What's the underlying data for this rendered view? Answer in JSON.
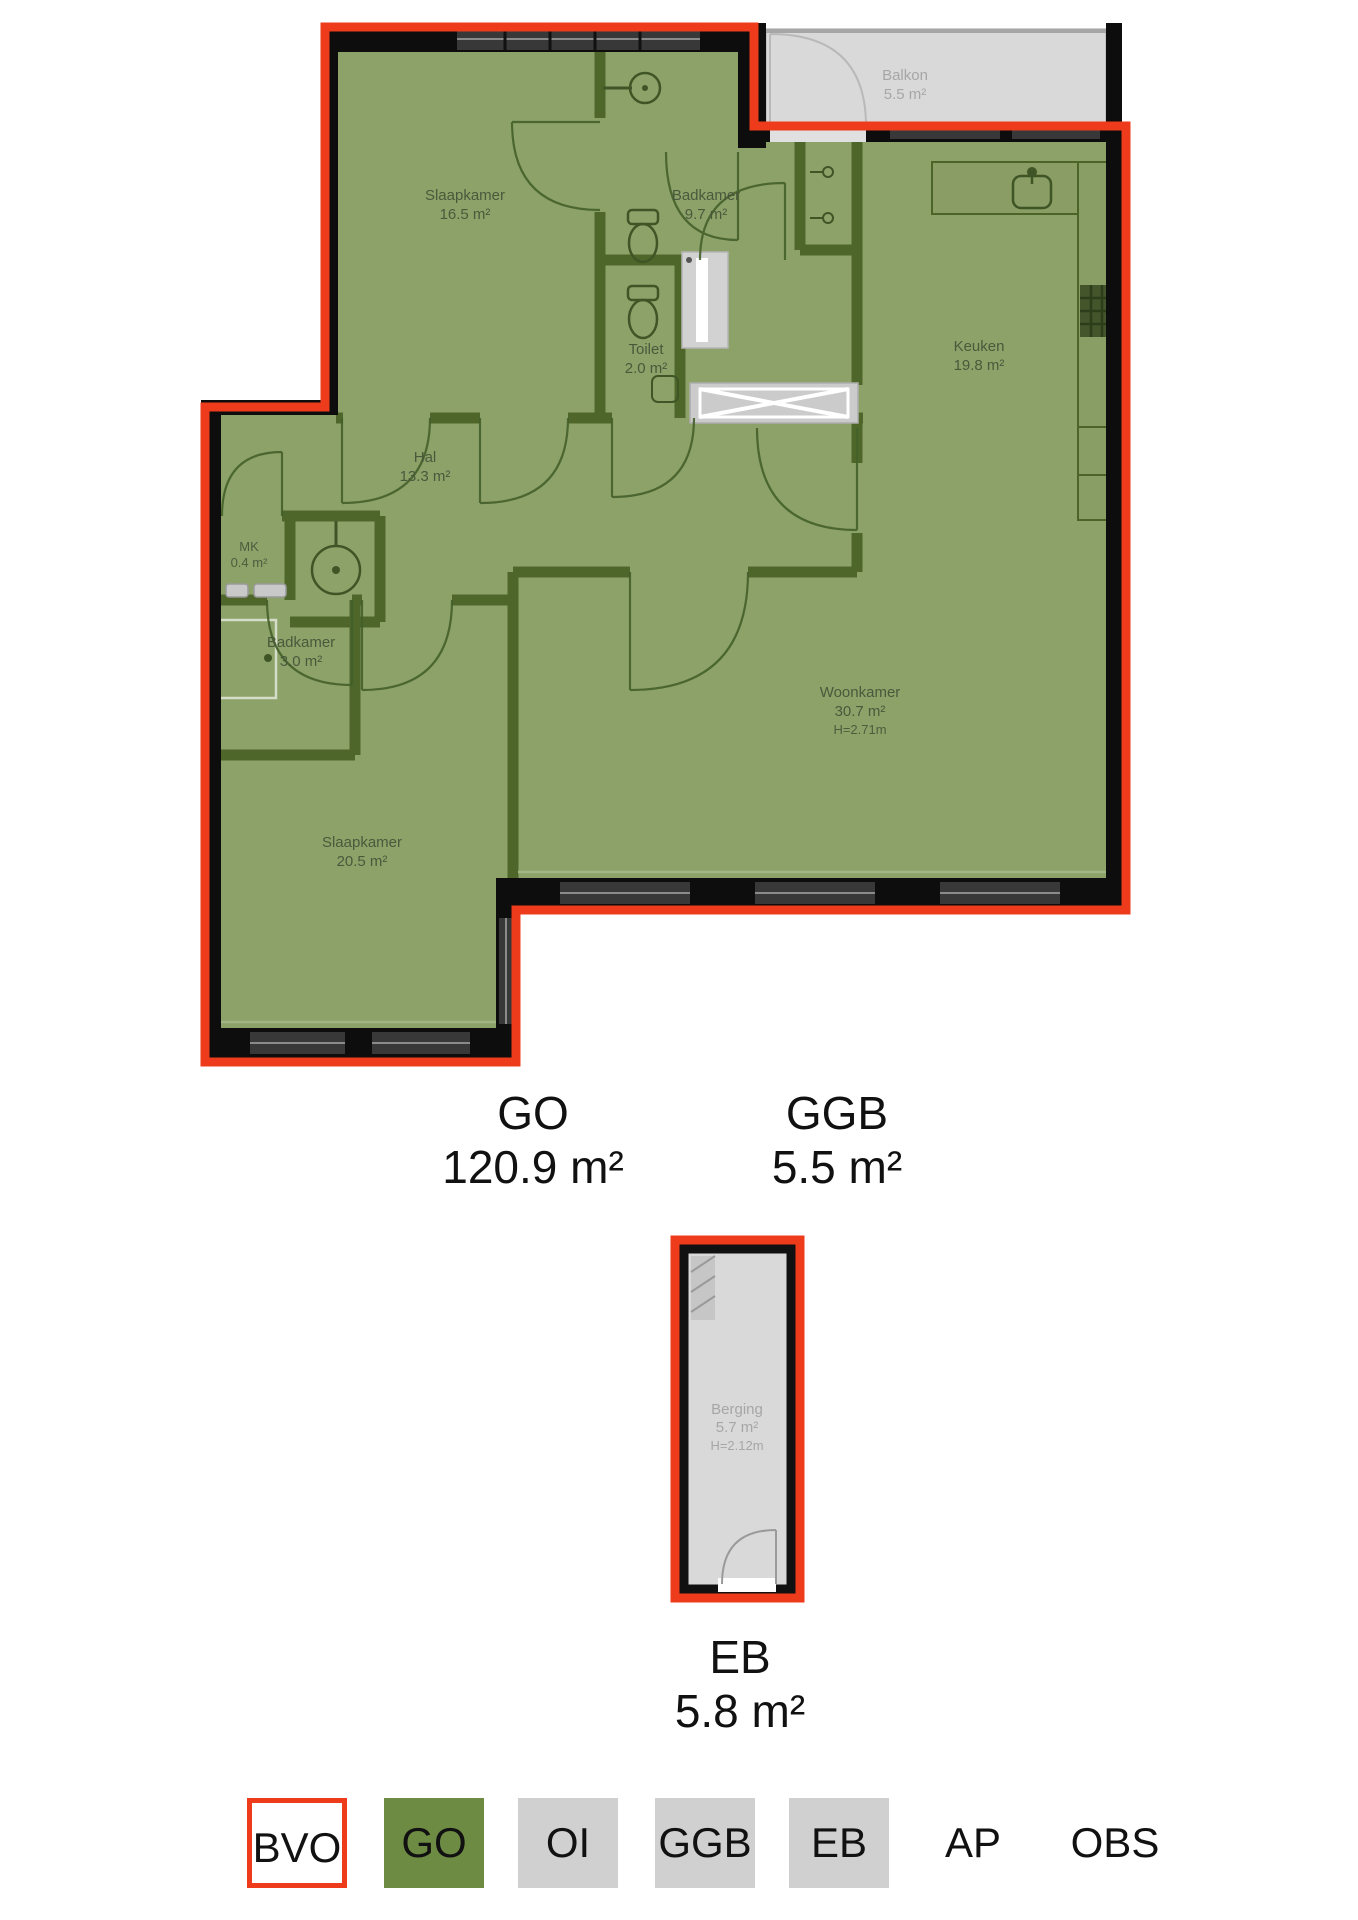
{
  "floorplan": {
    "unit": {
      "rooms": [
        {
          "name": "Slaapkamer",
          "area": "16.5 m²"
        },
        {
          "name": "Badkamer",
          "area": "9.7 m²"
        },
        {
          "name": "Toilet",
          "area": "2.0 m²"
        },
        {
          "name": "Keuken",
          "area": "19.8 m²"
        },
        {
          "name": "Hal",
          "area": "13.3 m²"
        },
        {
          "name": "MK",
          "area": "0.4 m²"
        },
        {
          "name": "Badkamer",
          "area": "3.0 m²"
        },
        {
          "name": "Woonkamer",
          "area": "30.7 m²",
          "height": "H=2.71m"
        },
        {
          "name": "Slaapkamer",
          "area": "20.5 m²"
        }
      ],
      "balcony": {
        "name": "Balkon",
        "area": "5.5 m²"
      }
    },
    "storage": {
      "name": "Berging",
      "area": "5.7 m²",
      "height": "H=2.12m"
    },
    "measurements": [
      {
        "code": "GO",
        "value": "120.9 m²"
      },
      {
        "code": "GGB",
        "value": "5.5 m²"
      },
      {
        "code": "EB",
        "value": "5.8 m²"
      }
    ],
    "legend": {
      "items": [
        {
          "code": "BVO",
          "style": "outline"
        },
        {
          "code": "GO",
          "style": "green"
        },
        {
          "code": "OI",
          "style": "gray"
        },
        {
          "code": "GGB",
          "style": "gray"
        },
        {
          "code": "EB",
          "style": "gray"
        },
        {
          "code": "AP",
          "style": "plain"
        },
        {
          "code": "OBS",
          "style": "plain"
        }
      ]
    },
    "colors": {
      "outline_red": "#ee3b1b",
      "room_green": "#8da269",
      "wall_olive": "#4c6428",
      "exterior_black": "#0d0d0d",
      "legend_green": "#6e8b44",
      "legend_gray": "#d0d0d0",
      "outdoor_gray": "#d9d9d9"
    }
  }
}
